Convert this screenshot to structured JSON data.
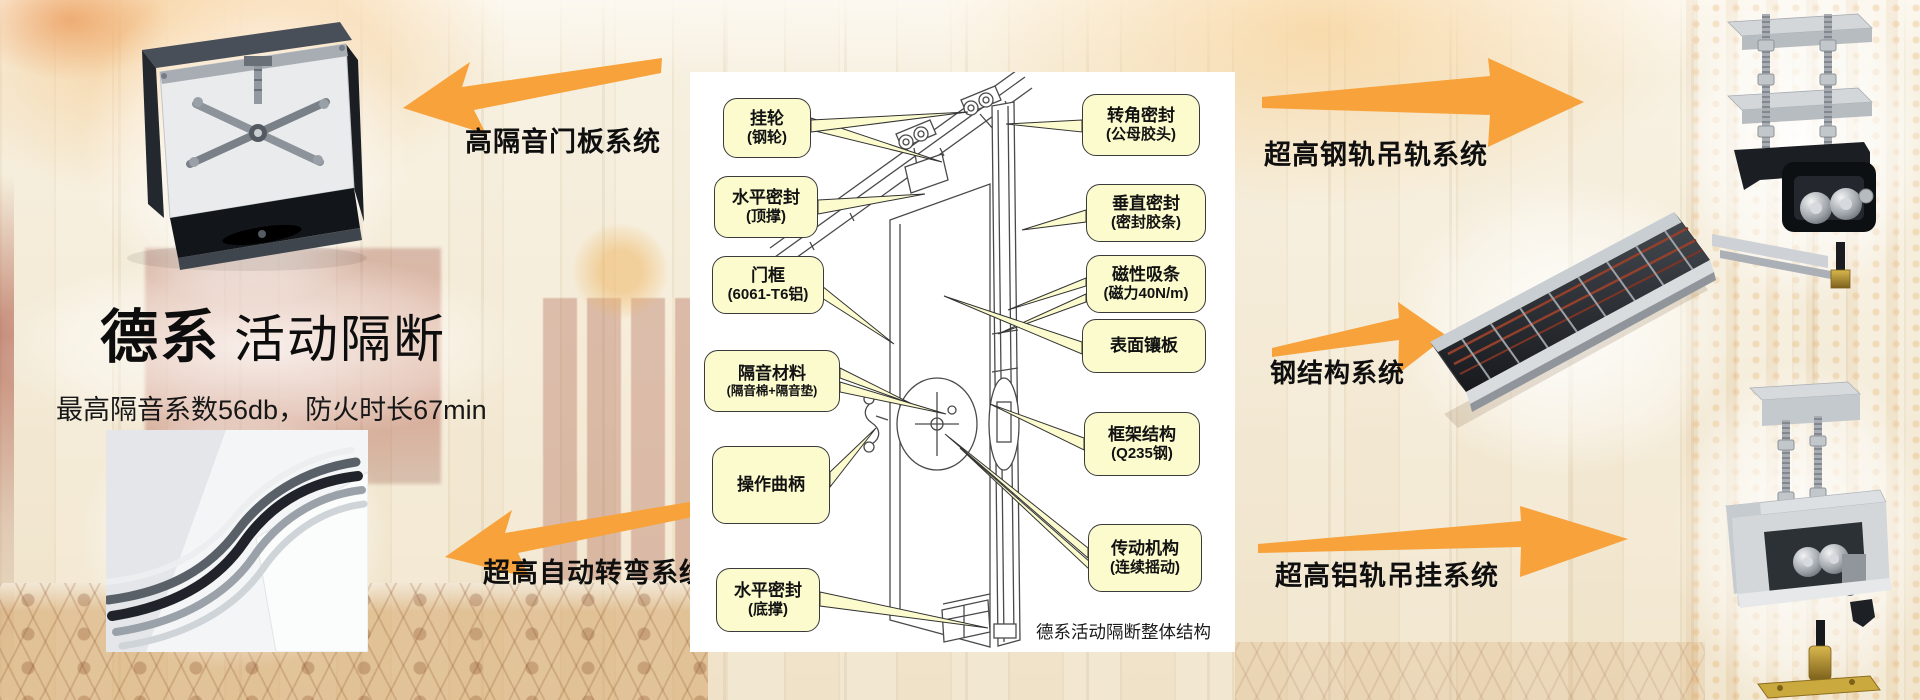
{
  "slide": {
    "left": {
      "system_label_top": "高隔音门板系统",
      "system_label_bottom": "超高自动转弯系统",
      "title_emphasis": "德系",
      "title_rest": "活动隔断",
      "subtitle": "最高隔音系数56db，防火时长67min"
    },
    "right": {
      "system_label_top": "超高钢轨吊轨系统",
      "system_label_middle": "钢结构系统",
      "system_label_bottom": "超高铝轨吊挂系统"
    },
    "diagram": {
      "caption": "德系活动隔断整体结构",
      "callouts_left": [
        {
          "line1": "挂轮",
          "line2": "(钢轮)"
        },
        {
          "line1": "水平密封",
          "line2": "(顶撑)"
        },
        {
          "line1": "门框",
          "line2": "(6061-T6铝)"
        },
        {
          "line1": "隔音材料",
          "line2": "(隔音棉+隔音垫)"
        },
        {
          "line1": "操作曲柄",
          "line2": ""
        },
        {
          "line1": "水平密封",
          "line2": "(底撑)"
        }
      ],
      "callouts_right": [
        {
          "line1": "转角密封",
          "line2": "(公母胶头)"
        },
        {
          "line1": "垂直密封",
          "line2": "(密封胶条)"
        },
        {
          "line1": "磁性吸条",
          "line2": "(磁力40N/m)"
        },
        {
          "line1": "表面镶板",
          "line2": ""
        },
        {
          "line1": "框架结构",
          "line2": "(Q235钢)"
        },
        {
          "line1": "传动机构",
          "line2": "(连续摇动)"
        }
      ]
    },
    "colors": {
      "arrow_orange": "#F7A23B",
      "callout_fill": "#FBFBCE",
      "callout_border": "#3A3A3A",
      "panel_background": "#FFFFFF"
    }
  }
}
